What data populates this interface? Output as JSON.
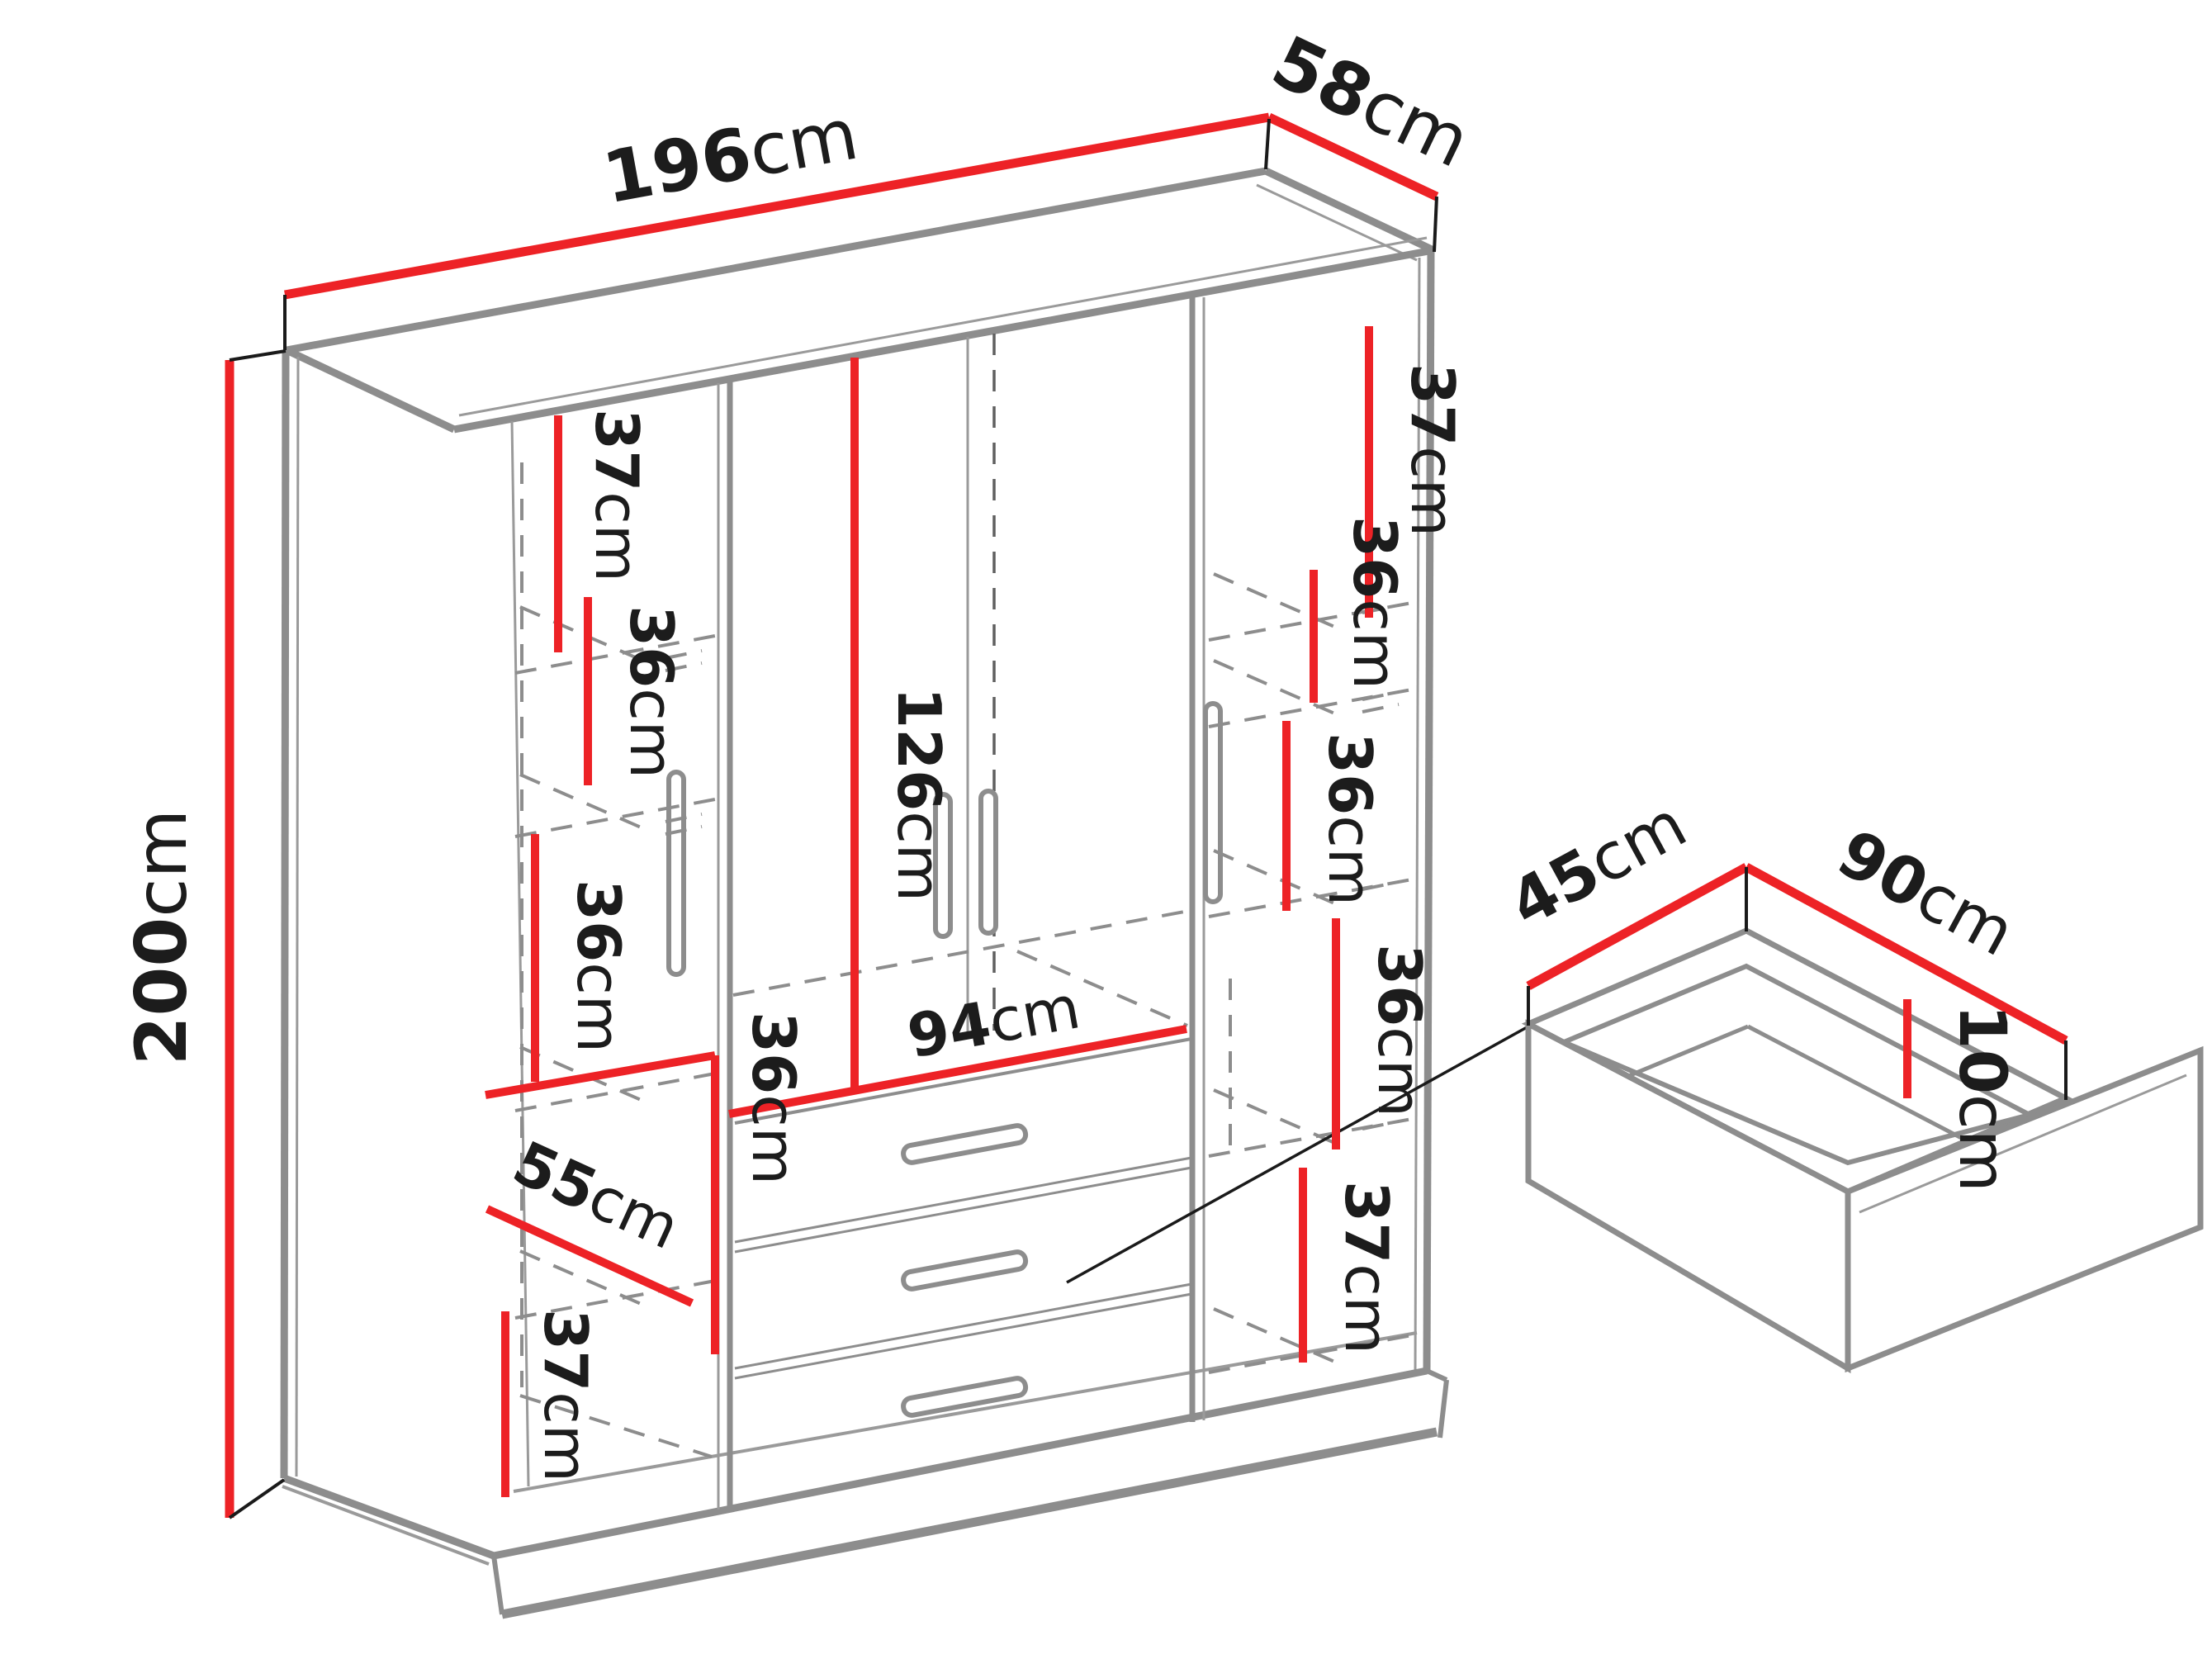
{
  "diagram": {
    "title": "wardrobe-dimensions-diagram",
    "unit": "cm",
    "measurements": {
      "width": {
        "value": "196",
        "unit": "cm"
      },
      "depth": {
        "value": "58",
        "unit": "cm"
      },
      "height": {
        "value": "200",
        "unit": "cm"
      },
      "left_top_shelf": {
        "value": "37",
        "unit": "cm"
      },
      "left_shelf_2": {
        "value": "36",
        "unit": "cm"
      },
      "left_shelf_3": {
        "value": "36",
        "unit": "cm"
      },
      "left_shelf_width": {
        "value": "55",
        "unit": "cm"
      },
      "left_lower_shelf": {
        "value": "36",
        "unit": "cm"
      },
      "left_bottom_shelf": {
        "value": "37",
        "unit": "cm"
      },
      "center_door_height": {
        "value": "126",
        "unit": "cm"
      },
      "center_width": {
        "value": "94",
        "unit": "cm"
      },
      "right_top_shelf": {
        "value": "37",
        "unit": "cm"
      },
      "right_shelf_2": {
        "value": "36",
        "unit": "cm"
      },
      "right_shelf_3": {
        "value": "36",
        "unit": "cm"
      },
      "right_shelf_4": {
        "value": "36",
        "unit": "cm"
      },
      "right_bottom_shelf": {
        "value": "37",
        "unit": "cm"
      },
      "drawer_depth": {
        "value": "45",
        "unit": "cm"
      },
      "drawer_width": {
        "value": "90",
        "unit": "cm"
      },
      "drawer_height": {
        "value": "10",
        "unit": "cm"
      }
    },
    "colors": {
      "dimension_line": "#ed2226",
      "outline": "#8d8d8d",
      "extension_line": "#1a1a1a",
      "text": "#1c1c1c"
    }
  }
}
